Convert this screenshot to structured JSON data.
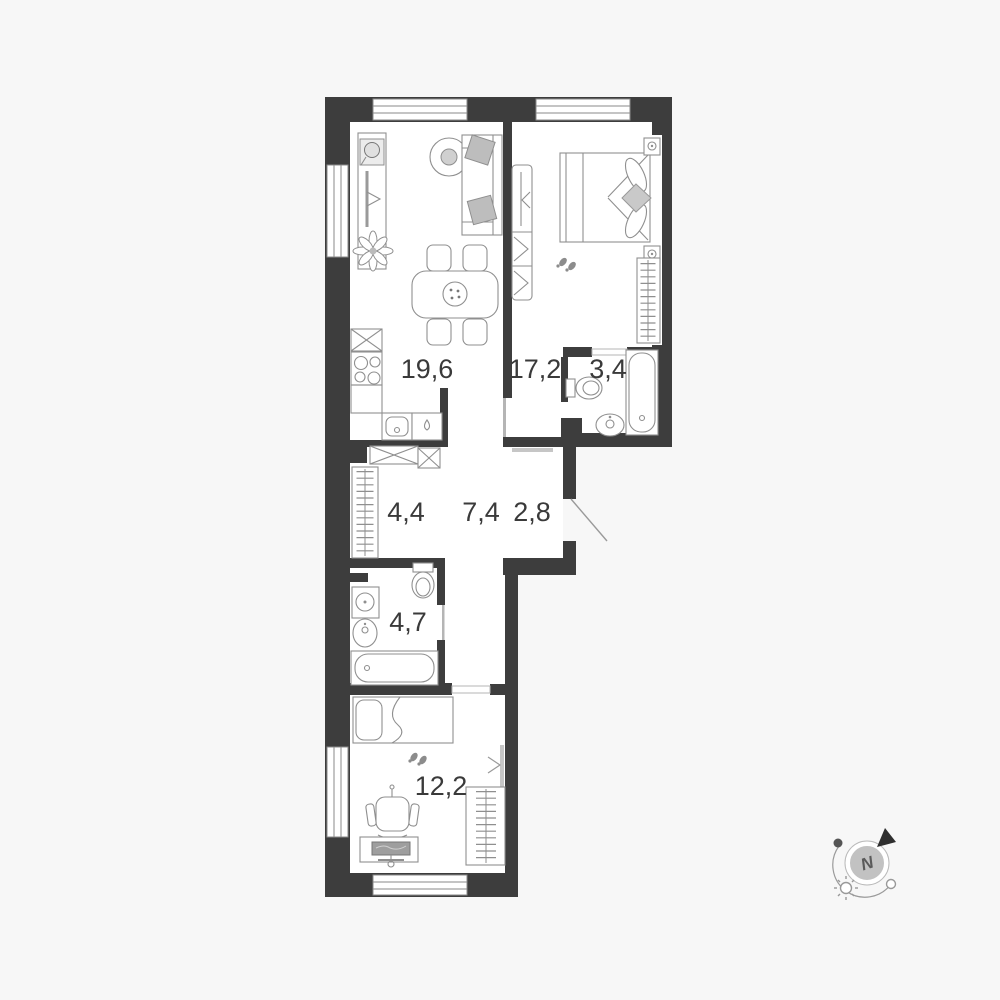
{
  "page": {
    "background_color": "#f7f7f7"
  },
  "floorplan": {
    "colors": {
      "wall": "#3d3d3d",
      "floor": "#ffffff",
      "furniture_line": "#8f8f8f",
      "label_text": "#3a3a3a"
    },
    "rooms": [
      {
        "id": "living-kitchen",
        "area": "19,6"
      },
      {
        "id": "bedroom-main",
        "area": "17,2"
      },
      {
        "id": "bathroom-small",
        "area": "3,4"
      },
      {
        "id": "hall-wardrobe",
        "area": "4,4"
      },
      {
        "id": "corridor",
        "area": "7,4"
      },
      {
        "id": "entry-hall",
        "area": "2,8"
      },
      {
        "id": "bathroom-main",
        "area": "4,7"
      },
      {
        "id": "bedroom-second",
        "area": "12,2"
      }
    ],
    "compass": {
      "north_label": "N"
    }
  }
}
